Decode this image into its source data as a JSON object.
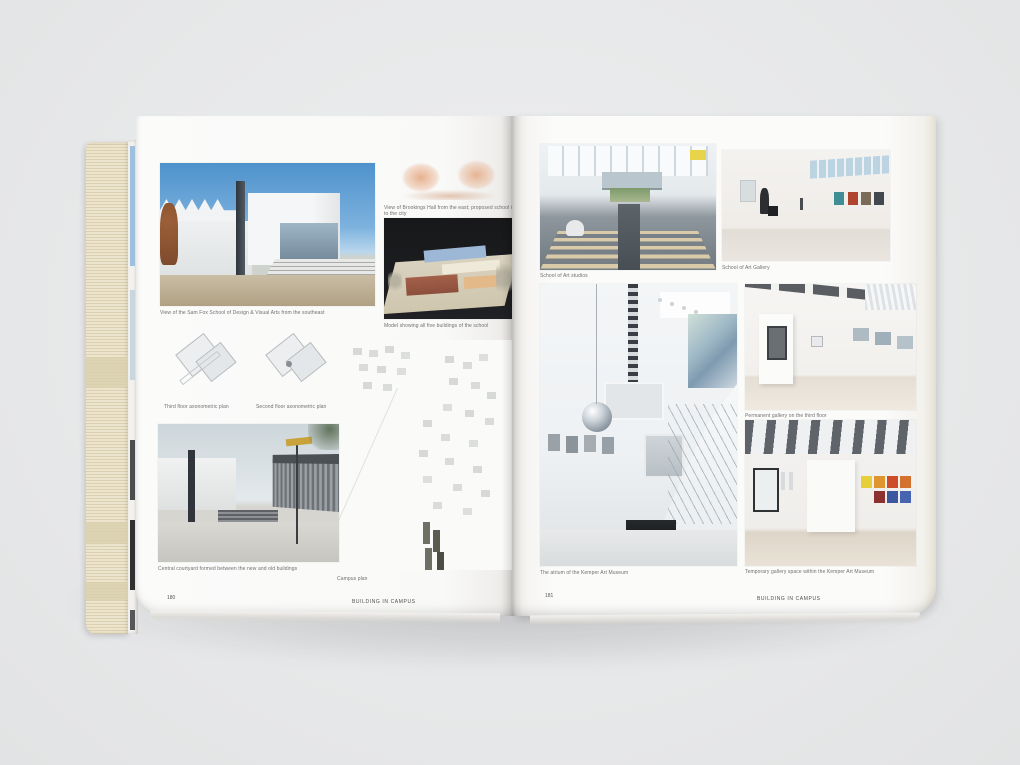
{
  "book": {
    "left_page": {
      "page_number": "180",
      "footer": "BUILDING IN CAMPUS",
      "captions": {
        "main_photo": "View of the Sam Fox School of Design & Visual Arts from the southeast",
        "sketch": "View of Brookings Hall from the east; proposed school is to the city",
        "model": "Model showing all five buildings of the school",
        "plan_third": "Third floor axonometric plan",
        "plan_second": "Second floor axonometric plan",
        "campus_plan": "Campus plan",
        "courtyard": "Central courtyard formed between the new and old buildings"
      }
    },
    "right_page": {
      "page_number": "181",
      "footer": "BUILDING IN CAMPUS",
      "captions": {
        "studios": "School of Art studios",
        "gallery": "School of Art Gallery",
        "atrium": "The atrium of the Kemper Art Museum",
        "permanent_gallery": "Permanent gallery on the third floor",
        "temporary_gallery": "Temporary gallery space within the Kemper Art Museum"
      }
    },
    "colors": {
      "background": "#e9eaeb",
      "page": "#fbfbfa",
      "fore_edge": "#e2d8ba",
      "sky": "#5e9bd2",
      "sketch_orange": "#dd8a55"
    }
  }
}
